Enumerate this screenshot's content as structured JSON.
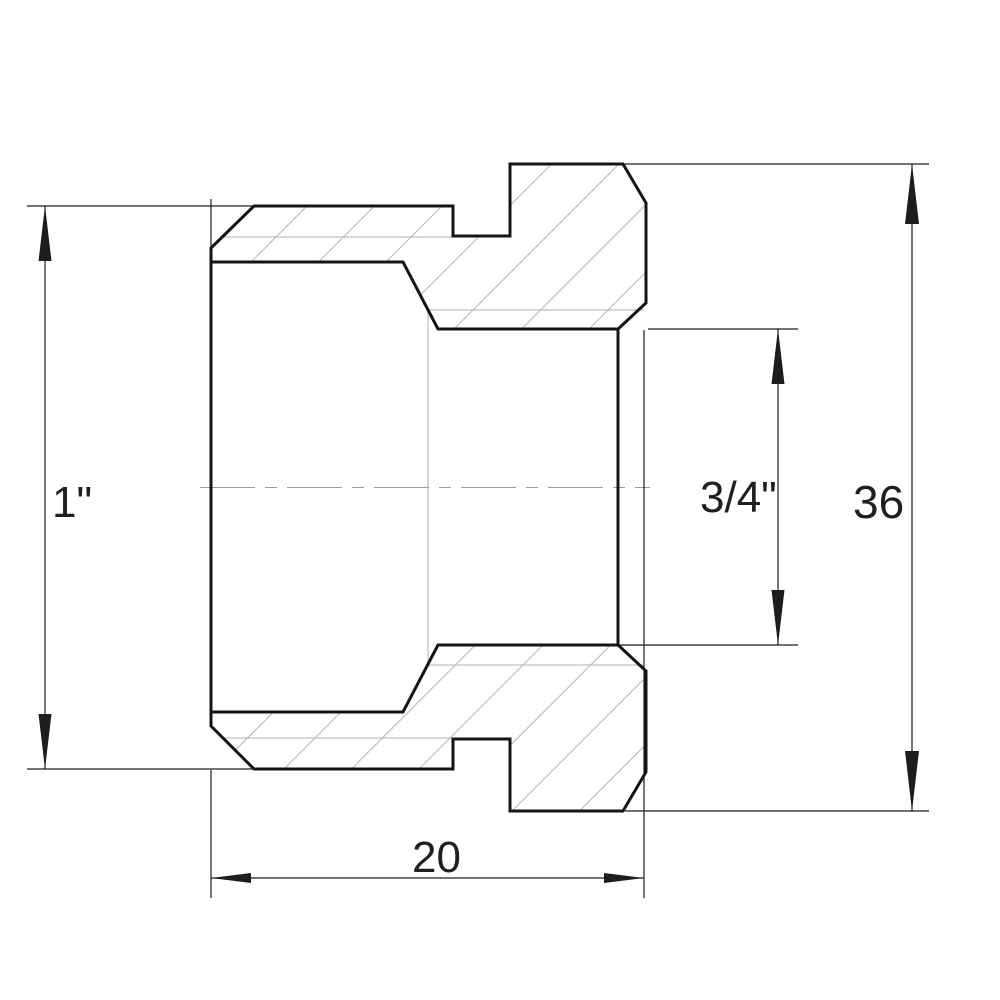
{
  "page": {
    "description": "Technical section drawing of a threaded reducing bushing 1 inch x 3/4 inch",
    "background": "#ffffff"
  },
  "colors": {
    "outline": "#141414",
    "dimension": "#1d1d1d",
    "thread_line": "#b2b2b2",
    "hatch": "#b7b7b7",
    "centerline": "#9c9c9c",
    "text": "#1f1f1f"
  },
  "drawing": {
    "viewbox": "0 0 1000 1000",
    "outline_width": 3,
    "thin_width": 1.2,
    "outline_path": "M211,248 L254,206 L453,206 L453,236 L510,236 L510,164 L623,164 L646,203 L646,303 L618,329 L618,645 L646,671 L646,772 L623,811 L510,811 L510,739 L453,739 L453,769 L254,769 L211,726 Z",
    "cavity_path": "M211,262 L403,262 L438,329 L618,329 L618,645 L438,645 L403,712 L211,712 Z",
    "hatch": {
      "c_start": 445.5,
      "step": 67.5,
      "count": 16,
      "y_top": 150,
      "y_bottom": 840,
      "width": 1
    },
    "centerline": {
      "x1": 200,
      "y1": 487.5,
      "x2": 650,
      "y2": 487.5,
      "dash": "55 10 12 10",
      "width": 1.1
    },
    "thread_lines": [
      [
        223,
        237,
        453,
        237
      ],
      [
        223,
        738,
        453,
        738
      ],
      [
        428,
        310,
        644,
        310
      ],
      [
        428,
        665,
        644,
        665
      ],
      [
        428,
        310,
        428,
        665
      ]
    ],
    "extension_lines": [
      [
        27,
        206,
        255,
        206
      ],
      [
        27,
        769,
        255,
        769
      ],
      [
        625,
        164,
        929,
        164
      ],
      [
        625,
        811,
        929,
        811
      ],
      [
        648,
        329,
        798,
        329
      ],
      [
        620,
        645,
        798,
        645
      ],
      [
        211,
        770,
        211,
        898
      ],
      [
        644,
        330,
        644,
        898
      ],
      [
        211,
        199,
        211,
        248
      ]
    ],
    "dimensions": [
      {
        "id": "dimension-1-inch",
        "label": "1\"",
        "line": [
          45,
          206,
          45,
          769
        ],
        "arrows": [
          {
            "tip": [
              45,
              206
            ],
            "dir": "up",
            "len": 55,
            "hw": 6.5
          },
          {
            "tip": [
              45,
              769
            ],
            "dir": "down",
            "len": 55,
            "hw": 6.5
          }
        ],
        "label_pos": [
          52,
          517
        ],
        "font_size": 44
      },
      {
        "id": "dimension-3-4-inch",
        "label": "3/4\"",
        "line": [
          778,
          329,
          778,
          645
        ],
        "arrows": [
          {
            "tip": [
              778,
              329
            ],
            "dir": "up",
            "len": 55,
            "hw": 6.5
          },
          {
            "tip": [
              778,
              645
            ],
            "dir": "down",
            "len": 55,
            "hw": 6.5
          }
        ],
        "label_pos": [
          700,
          512
        ],
        "font_size": 44
      },
      {
        "id": "dimension-36",
        "label": "36",
        "line": [
          912,
          164,
          912,
          811
        ],
        "arrows": [
          {
            "tip": [
              912,
              164
            ],
            "dir": "up",
            "len": 60,
            "hw": 7
          },
          {
            "tip": [
              912,
              811
            ],
            "dir": "down",
            "len": 60,
            "hw": 7
          }
        ],
        "label_pos": [
          853,
          518
        ],
        "font_size": 46
      },
      {
        "id": "dimension-20",
        "label": "20",
        "line": [
          211,
          878,
          644,
          878
        ],
        "arrows": [
          {
            "tip": [
              211,
              878
            ],
            "dir": "left",
            "len": 40,
            "hw": 5
          },
          {
            "tip": [
              644,
              878
            ],
            "dir": "right",
            "len": 40,
            "hw": 5
          }
        ],
        "label_pos": [
          412,
          872
        ],
        "font_size": 44
      }
    ]
  }
}
